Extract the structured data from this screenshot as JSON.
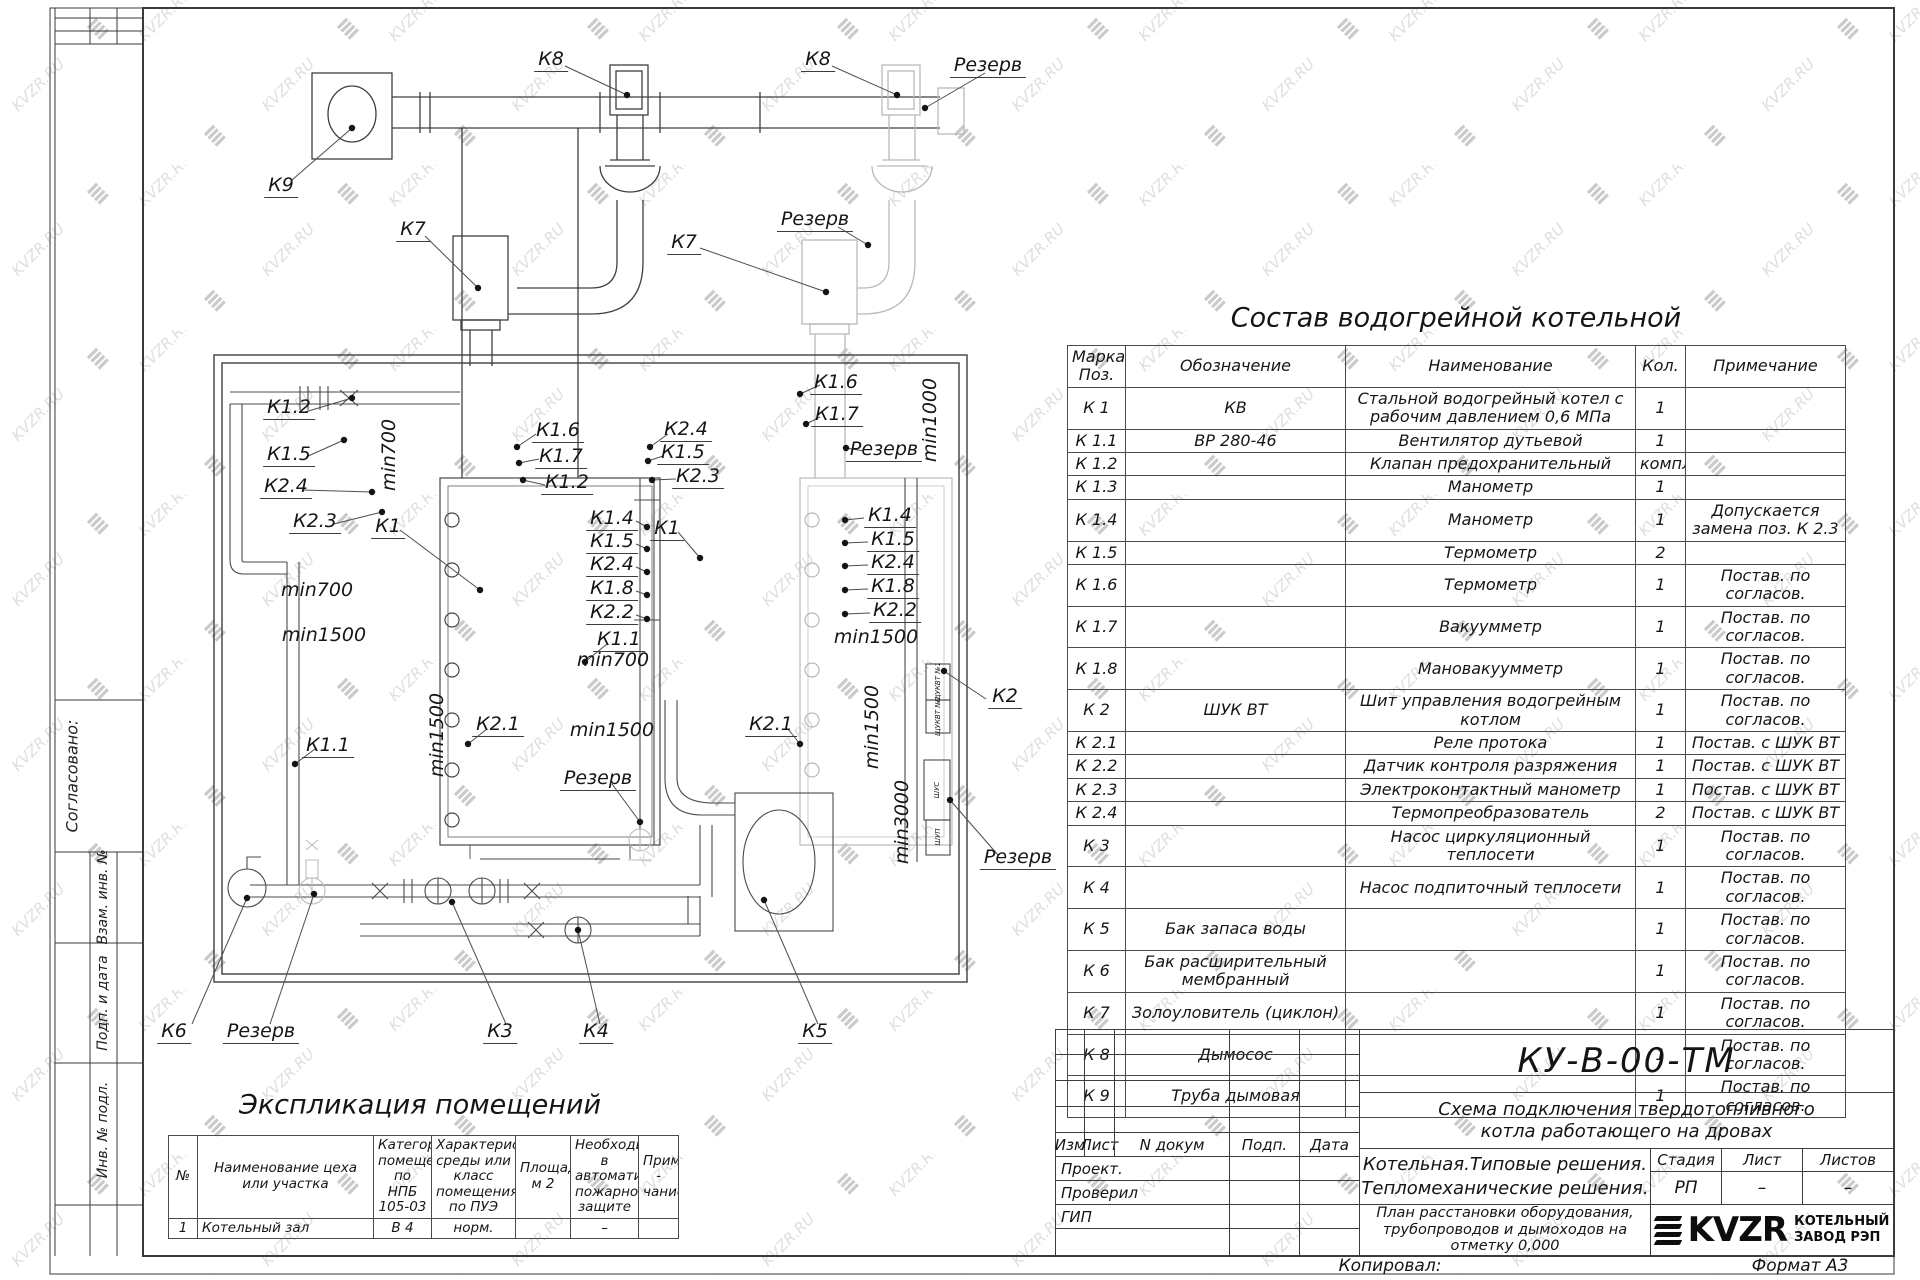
{
  "watermark": {
    "text": "KVZR.RU"
  },
  "sidebar": {
    "agreed": "Согласовано:",
    "sections": [
      "Взам. инв. №",
      "Подп. и дата",
      "Инв. № подл."
    ]
  },
  "plan": {
    "labels": [
      {
        "t": "К8",
        "x": 551,
        "y": 60,
        "c": "eq"
      },
      {
        "t": "К8",
        "x": 818,
        "y": 60,
        "c": "eq"
      },
      {
        "t": "Резерв",
        "x": 988,
        "y": 66,
        "c": "eq"
      },
      {
        "t": "К9",
        "x": 281,
        "y": 186,
        "c": "eq"
      },
      {
        "t": "К7",
        "x": 413,
        "y": 230,
        "c": "eq"
      },
      {
        "t": "К7",
        "x": 684,
        "y": 243,
        "c": "eq"
      },
      {
        "t": "Резерв",
        "x": 815,
        "y": 220,
        "c": "eq"
      },
      {
        "t": "К1.2",
        "x": 289,
        "y": 408,
        "c": "eq"
      },
      {
        "t": "К1.5",
        "x": 289,
        "y": 455,
        "c": "eq"
      },
      {
        "t": "К2.4",
        "x": 286,
        "y": 487,
        "c": "eq"
      },
      {
        "t": "min700",
        "x": 389,
        "y": 455,
        "c": "rot"
      },
      {
        "t": "min700",
        "x": 317,
        "y": 590,
        "c": "dim"
      },
      {
        "t": "min1500",
        "x": 324,
        "y": 635,
        "c": "dim"
      },
      {
        "t": "К1.6",
        "x": 558,
        "y": 431,
        "c": "eq"
      },
      {
        "t": "К1.7",
        "x": 561,
        "y": 457,
        "c": "eq"
      },
      {
        "t": "К1.2",
        "x": 567,
        "y": 483,
        "c": "eq"
      },
      {
        "t": "К2.4",
        "x": 686,
        "y": 430,
        "c": "eq"
      },
      {
        "t": "К1.5",
        "x": 683,
        "y": 453,
        "c": "eq"
      },
      {
        "t": "К2.3",
        "x": 698,
        "y": 477,
        "c": "eq"
      },
      {
        "t": "К2.3",
        "x": 315,
        "y": 522,
        "c": "eq"
      },
      {
        "t": "К1",
        "x": 388,
        "y": 527,
        "c": "eq"
      },
      {
        "t": "К1.4",
        "x": 612,
        "y": 519,
        "c": "eq"
      },
      {
        "t": "К1.5",
        "x": 612,
        "y": 542,
        "c": "eq"
      },
      {
        "t": "К1",
        "x": 667,
        "y": 529,
        "c": "eq"
      },
      {
        "t": "К2.4",
        "x": 612,
        "y": 565,
        "c": "eq"
      },
      {
        "t": "К1.8",
        "x": 612,
        "y": 589,
        "c": "eq"
      },
      {
        "t": "К2.2",
        "x": 612,
        "y": 613,
        "c": "eq"
      },
      {
        "t": "К1.1",
        "x": 619,
        "y": 640,
        "c": "eq"
      },
      {
        "t": "min700",
        "x": 613,
        "y": 660,
        "c": "dim"
      },
      {
        "t": "К1.6",
        "x": 836,
        "y": 383,
        "c": "eq"
      },
      {
        "t": "К1.7",
        "x": 837,
        "y": 415,
        "c": "eq"
      },
      {
        "t": "min1000",
        "x": 930,
        "y": 420,
        "c": "rot"
      },
      {
        "t": "Резерв",
        "x": 884,
        "y": 450,
        "c": "eq"
      },
      {
        "t": "К1.4",
        "x": 890,
        "y": 516,
        "c": "eq"
      },
      {
        "t": "К1.5",
        "x": 893,
        "y": 540,
        "c": "eq"
      },
      {
        "t": "К2.4",
        "x": 893,
        "y": 563,
        "c": "eq"
      },
      {
        "t": "К1.8",
        "x": 893,
        "y": 587,
        "c": "eq"
      },
      {
        "t": "К2.2",
        "x": 895,
        "y": 611,
        "c": "eq"
      },
      {
        "t": "min1500",
        "x": 876,
        "y": 637,
        "c": "dim"
      },
      {
        "t": "min1500",
        "x": 437,
        "y": 735,
        "c": "rot"
      },
      {
        "t": "К2.1",
        "x": 498,
        "y": 725,
        "c": "eq"
      },
      {
        "t": "min1500",
        "x": 612,
        "y": 730,
        "c": "dim"
      },
      {
        "t": "К2.1",
        "x": 771,
        "y": 725,
        "c": "eq"
      },
      {
        "t": "min1500",
        "x": 872,
        "y": 727,
        "c": "rot"
      },
      {
        "t": "К1.1",
        "x": 328,
        "y": 746,
        "c": "eq"
      },
      {
        "t": "Резерв",
        "x": 598,
        "y": 779,
        "c": "eq"
      },
      {
        "t": "min3000",
        "x": 902,
        "y": 822,
        "c": "rot"
      },
      {
        "t": "К2",
        "x": 1005,
        "y": 697,
        "c": "eq"
      },
      {
        "t": "Резерв",
        "x": 1018,
        "y": 858,
        "c": "eq"
      },
      {
        "t": "К6",
        "x": 174,
        "y": 1032,
        "c": "eq"
      },
      {
        "t": "Резерв",
        "x": 261,
        "y": 1032,
        "c": "eq"
      },
      {
        "t": "К3",
        "x": 500,
        "y": 1032,
        "c": "eq"
      },
      {
        "t": "К4",
        "x": 596,
        "y": 1032,
        "c": "eq"
      },
      {
        "t": "К5",
        "x": 815,
        "y": 1032,
        "c": "eq"
      }
    ],
    "cabinets": [
      {
        "t": "ЩУКВТ №1",
        "x": 938,
        "y": 682
      },
      {
        "t": "ЩУКВТ №2",
        "x": 938,
        "y": 716
      },
      {
        "t": "ШУС",
        "x": 937,
        "y": 790
      },
      {
        "t": "ШУП",
        "x": 938,
        "y": 837
      }
    ],
    "leaders": [
      [
        627,
        95,
        565,
        66
      ],
      [
        897,
        95,
        832,
        66
      ],
      [
        925,
        108,
        985,
        73
      ],
      [
        352,
        128,
        292,
        180
      ],
      [
        478,
        288,
        425,
        236
      ],
      [
        826,
        292,
        700,
        248
      ],
      [
        868,
        245,
        838,
        227
      ],
      [
        352,
        398,
        305,
        412
      ],
      [
        344,
        440,
        306,
        457
      ],
      [
        372,
        492,
        303,
        490
      ],
      [
        382,
        512,
        334,
        524
      ],
      [
        480,
        590,
        400,
        530
      ],
      [
        517,
        447,
        536,
        434
      ],
      [
        519,
        463,
        539,
        459
      ],
      [
        523,
        480,
        545,
        485
      ],
      [
        650,
        447,
        668,
        434
      ],
      [
        648,
        461,
        663,
        456
      ],
      [
        652,
        480,
        676,
        479
      ],
      [
        647,
        527,
        636,
        521
      ],
      [
        647,
        549,
        636,
        544
      ],
      [
        647,
        572,
        636,
        567
      ],
      [
        647,
        595,
        636,
        591
      ],
      [
        647,
        619,
        636,
        615
      ],
      [
        585,
        662,
        607,
        644
      ],
      [
        700,
        558,
        678,
        532
      ],
      [
        845,
        520,
        864,
        518
      ],
      [
        845,
        543,
        868,
        542
      ],
      [
        845,
        566,
        868,
        565
      ],
      [
        845,
        590,
        868,
        589
      ],
      [
        845,
        614,
        870,
        613
      ],
      [
        800,
        394,
        820,
        385
      ],
      [
        806,
        424,
        820,
        417
      ],
      [
        846,
        448,
        864,
        451
      ],
      [
        944,
        671,
        986,
        699
      ],
      [
        950,
        800,
        998,
        855
      ],
      [
        468,
        744,
        487,
        729
      ],
      [
        800,
        744,
        788,
        729
      ],
      [
        295,
        764,
        315,
        749
      ],
      [
        640,
        822,
        612,
        784
      ],
      [
        247,
        898,
        192,
        1024
      ],
      [
        314,
        894,
        270,
        1024
      ],
      [
        452,
        902,
        506,
        1024
      ],
      [
        578,
        930,
        600,
        1024
      ],
      [
        764,
        900,
        818,
        1024
      ]
    ]
  },
  "spec_table": {
    "title": "Состав водогрейной котельной",
    "headers": [
      "Марка Поз.",
      "Обозначение",
      "Наименование",
      "Кол.",
      "Примечание"
    ],
    "rows": [
      [
        "К 1",
        "КВ",
        "Стальной водогрейный котел с рабочим давлением 0,6  МПа",
        "1",
        ""
      ],
      [
        "К 1.1",
        "ВР 280-46",
        "Вентилятор дутьевой",
        "1",
        ""
      ],
      [
        "К 1.2",
        "",
        "Клапан предохранительный",
        "компл.",
        ""
      ],
      [
        "К 1.3",
        "",
        "Манометр",
        "1",
        ""
      ],
      [
        "К 1.4",
        "",
        "Манометр",
        "1",
        "Допускается замена поз. К 2.3"
      ],
      [
        "К 1.5",
        "",
        "Термометр",
        "2",
        ""
      ],
      [
        "К 1.6",
        "",
        "Термометр",
        "1",
        "Постав. по согласов."
      ],
      [
        "К 1.7",
        "",
        "Вакуумметр",
        "1",
        "Постав. по согласов."
      ],
      [
        "К 1.8",
        "",
        "Мановакуумметр",
        "1",
        "Постав. по согласов."
      ],
      [
        "К 2",
        "ШУК ВТ",
        "Шит управления водогрейным котлом",
        "1",
        "Постав. по согласов."
      ],
      [
        "К 2.1",
        "",
        "Реле протока",
        "1",
        "Постав. с ШУК ВТ"
      ],
      [
        "К 2.2",
        "",
        "Датчик контроля разряжения",
        "1",
        "Постав. с ШУК ВТ"
      ],
      [
        "К 2.3",
        "",
        "Электроконтактный манометр",
        "1",
        "Постав. с ШУК ВТ"
      ],
      [
        "К 2.4",
        "",
        "Термопреобразователь",
        "2",
        "Постав. с ШУК ВТ"
      ],
      [
        "К 3",
        "",
        "Насос циркуляционный теплосети",
        "1",
        "Постав. по согласов."
      ],
      [
        "К 4",
        "",
        "Насос подпиточный теплосети",
        "1",
        "Постав. по согласов."
      ],
      [
        "К 5",
        "Бак запаса воды",
        "",
        "1",
        "Постав. по согласов."
      ],
      [
        "К 6",
        "Бак расширительный мембранный",
        "",
        "1",
        "Постав. по согласов."
      ],
      [
        "К 7",
        "Золоуловитель  (циклон)",
        "",
        "1",
        "Постав. по согласов."
      ],
      [
        "К 8",
        "Дымосос",
        "",
        "1",
        "Постав. по согласов."
      ],
      [
        "К 9",
        "Труба дымовая",
        "",
        "1",
        "Постав. по согласов."
      ]
    ]
  },
  "explication": {
    "title": "Экспликация помещений",
    "headers": [
      "№",
      "Наименование цеха или участка",
      "Категория помещения по НПБ 105-03",
      "Характеристика среды или класс помещения по ПУЭ",
      "Площадь, м 2",
      "Необходимость в автоматической пожарной защите",
      "Приме - чание"
    ],
    "rows": [
      [
        "1",
        "Котельный зал",
        "В 4",
        "норм.",
        "",
        "–",
        ""
      ]
    ]
  },
  "titleblock": {
    "doc_number": "КУ-В-00-ТМ",
    "subtitle1": "Схема подключения твердотопливного",
    "subtitle2": "котла работающего на дровах",
    "org1": "Котельная.Типовые решения.",
    "org2": "Тепломеханические решения.",
    "stage_label": "Стадия",
    "sheet_label": "Лист",
    "sheets_label": "Листов",
    "stage_value": "РП",
    "sheet_value": "–",
    "sheets_value": "–",
    "drawing_title1": "План расстановки оборудования,",
    "drawing_title2": "трубопроводов и дымоходов на",
    "drawing_title3": "отметку  0,000",
    "cols": [
      "Изм",
      "Лист",
      "N докум",
      "Подп.",
      "Дата"
    ],
    "sign_rows": [
      "Проект.",
      "Проверил",
      "ГИП"
    ],
    "logo_word": "KVZR",
    "logo_sub1": "КОТЕЛЬНЫЙ",
    "logo_sub2": "ЗАВОД РЭП",
    "footer_copy": "Копировал:",
    "footer_format": "Формат А3"
  }
}
